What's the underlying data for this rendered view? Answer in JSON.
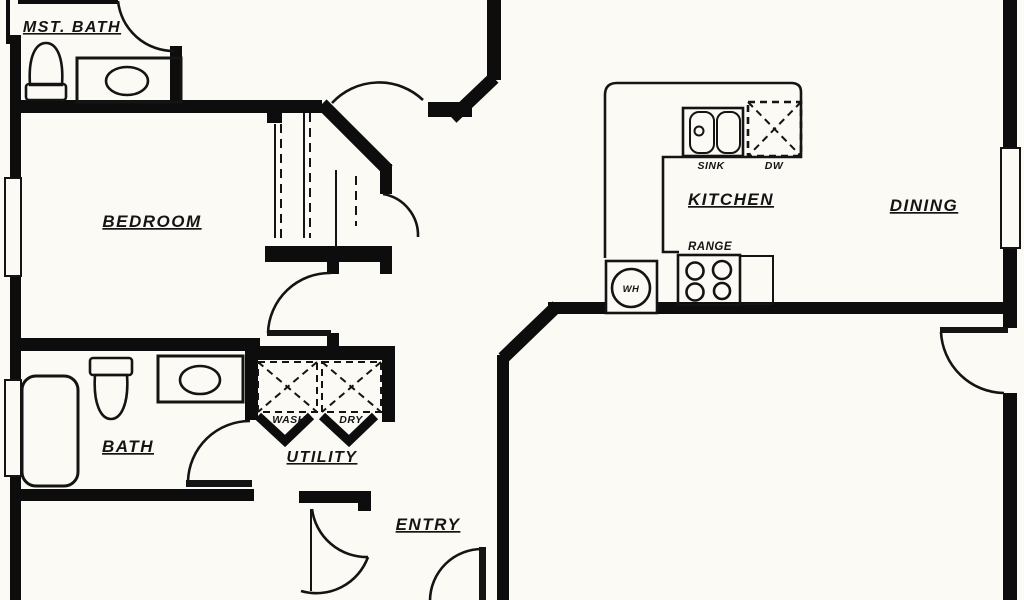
{
  "meta": {
    "title": "Residential floor plan drawing"
  },
  "colors": {
    "wall": "#0d0d0d",
    "line": "#141414",
    "background": "#fbfaf5"
  },
  "rooms": [
    {
      "id": "mst-bath",
      "label": "MST. BATH"
    },
    {
      "id": "bedroom",
      "label": "BEDROOM"
    },
    {
      "id": "kitchen",
      "label": "KITCHEN"
    },
    {
      "id": "dining",
      "label": "DINING"
    },
    {
      "id": "bath",
      "label": "BATH"
    },
    {
      "id": "utility",
      "label": "UTILITY"
    },
    {
      "id": "entry",
      "label": "ENTRY"
    }
  ],
  "fixtures": [
    {
      "id": "sink",
      "label": "SINK"
    },
    {
      "id": "dw",
      "label": "DW"
    },
    {
      "id": "range",
      "label": "RANGE"
    },
    {
      "id": "wh",
      "label": "WH"
    },
    {
      "id": "wash",
      "label": "WASH"
    },
    {
      "id": "dry",
      "label": "DRY"
    }
  ]
}
